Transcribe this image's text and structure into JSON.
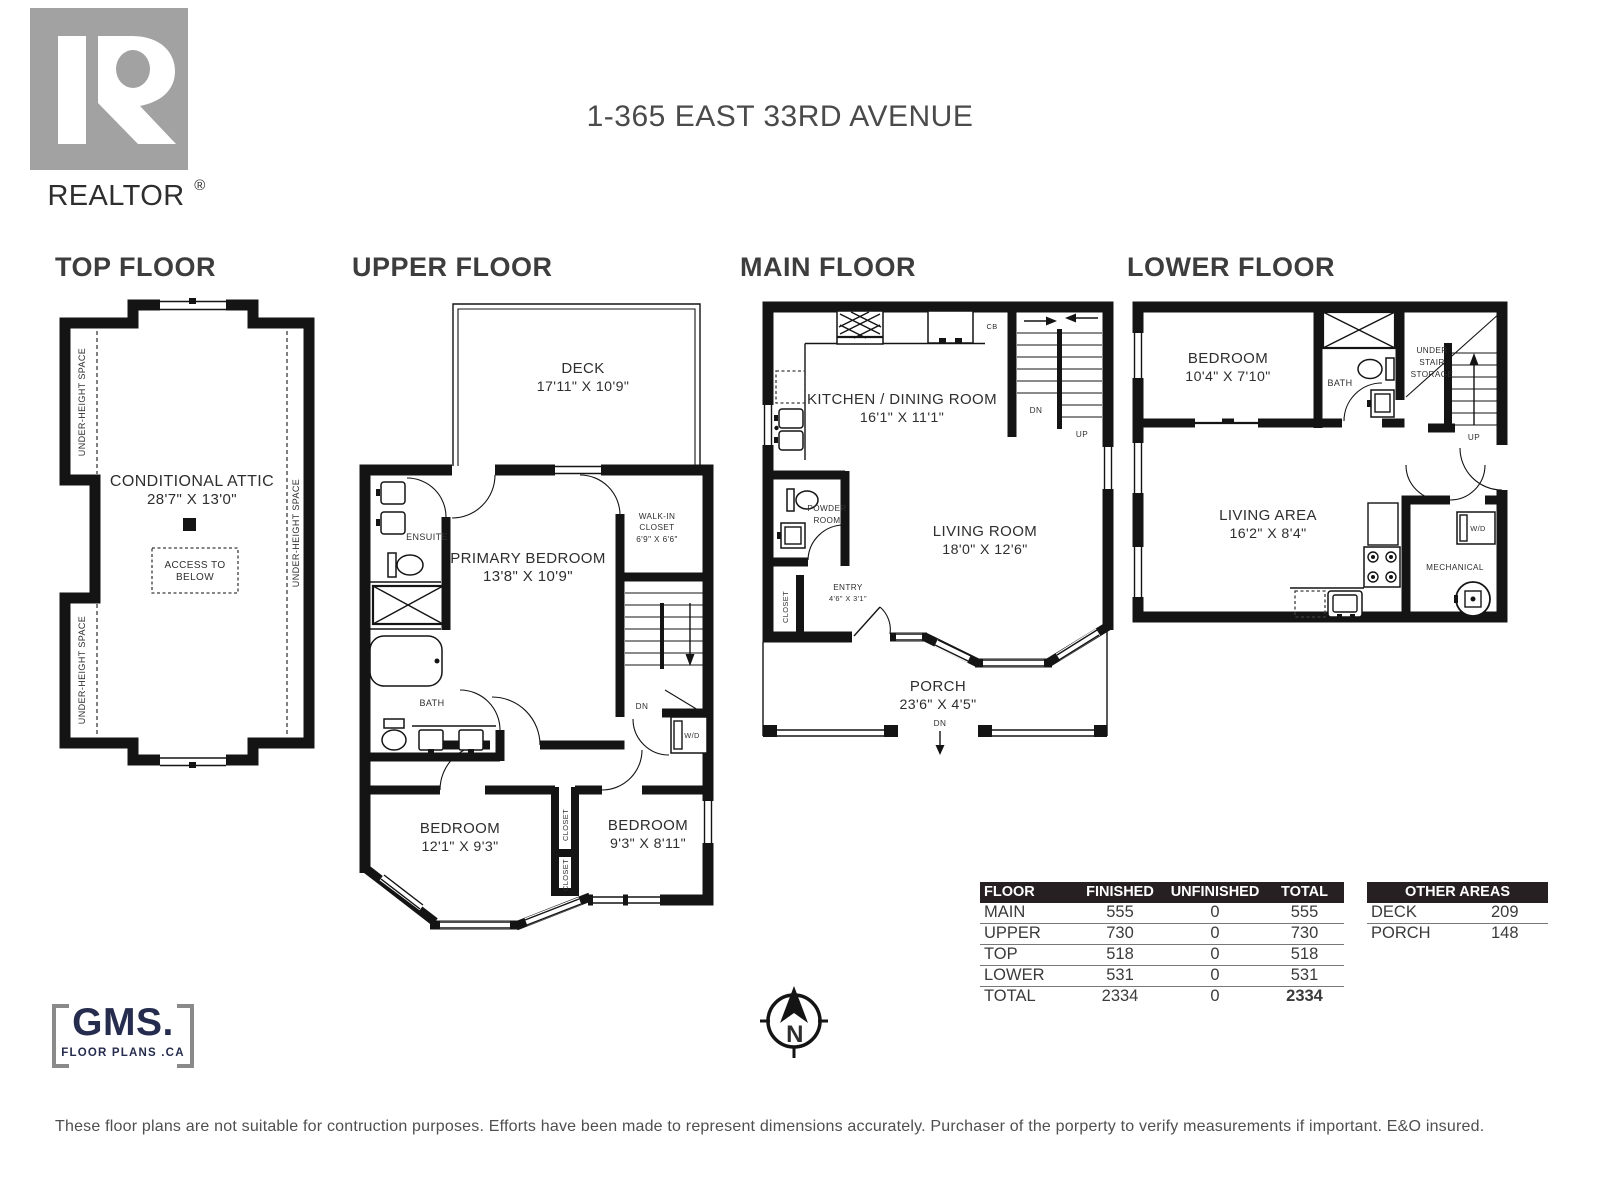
{
  "header": {
    "title": "1-365 EAST 33RD AVENUE",
    "realtor_logo": {
      "text": "REALTOR",
      "reg": "®"
    }
  },
  "colors": {
    "wall": "#141414",
    "logo_gray": "#a2a2a2",
    "gms_navy": "#252c4e",
    "table_header_bg": "#272022"
  },
  "floors": {
    "top": {
      "title": "TOP FLOOR",
      "attic_name": "CONDITIONAL ATTIC",
      "attic_dims": "28'7\" X 13'0\"",
      "access_line1": "ACCESS TO",
      "access_line2": "BELOW",
      "under_height": "UNDER-HEIGHT SPACE"
    },
    "upper": {
      "title": "UPPER FLOOR",
      "deck_name": "DECK",
      "deck_dims": "17'11\" X 10'9\"",
      "ensuite": "ENSUITE",
      "primary_name": "PRIMARY BEDROOM",
      "primary_dims": "13'8\" X 10'9\"",
      "wic_line1": "WALK-IN",
      "wic_line2": "CLOSET",
      "wic_dims": "6'9\" X 6'6\"",
      "bath": "BATH",
      "dn": "DN",
      "wd": "W/D",
      "bedroom1_name": "BEDROOM",
      "bedroom1_dims": "12'1\" X 9'3\"",
      "bedroom2_name": "BEDROOM",
      "bedroom2_dims": "9'3\" X 8'11\"",
      "closet": "CLOSET"
    },
    "main": {
      "title": "MAIN FLOOR",
      "kitchen_name": "KITCHEN / DINING ROOM",
      "kitchen_dims": "16'1\" X 11'1\"",
      "cb": "CB",
      "dn": "DN",
      "up": "UP",
      "powder_line1": "POWDER",
      "powder_line2": "ROOM",
      "living_name": "LIVING ROOM",
      "living_dims": "18'0\" X 12'6\"",
      "closet": "CLOSET",
      "entry_name": "ENTRY",
      "entry_dims": "4'6\" X 3'1\"",
      "porch_name": "PORCH",
      "porch_dims": "23'6\" X 4'5\"",
      "porch_dn": "DN"
    },
    "lower": {
      "title": "LOWER FLOOR",
      "bedroom_name": "BEDROOM",
      "bedroom_dims": "10'4\" X 7'10\"",
      "bath": "BATH",
      "storage_line1": "UNDER",
      "storage_line2": "STAIR",
      "storage_line3": "STORAGE",
      "up": "UP",
      "living_name": "LIVING AREA",
      "living_dims": "16'2\" X 8'4\"",
      "wd": "W/D",
      "mechanical": "MECHANICAL"
    }
  },
  "compass": {
    "north": "N"
  },
  "tables": {
    "area": {
      "headers": [
        "FLOOR",
        "FINISHED",
        "UNFINISHED",
        "TOTAL"
      ],
      "rows": [
        [
          "MAIN",
          "555",
          "0",
          "555"
        ],
        [
          "UPPER",
          "730",
          "0",
          "730"
        ],
        [
          "TOP",
          "518",
          "0",
          "518"
        ],
        [
          "LOWER",
          "531",
          "0",
          "531"
        ],
        [
          "TOTAL",
          "2334",
          "0",
          "2334"
        ]
      ]
    },
    "other": {
      "header": "OTHER AREAS",
      "rows": [
        [
          "DECK",
          "209"
        ],
        [
          "PORCH",
          "148"
        ]
      ]
    }
  },
  "gms": {
    "name": "GMS.",
    "tagline": "FLOOR PLANS .CA"
  },
  "disclaimer": "These floor plans are not suitable for contruction purposes. Efforts have been made to represent dimensions accurately. Purchaser of the porperty to verify measurements if important. E&O insured."
}
